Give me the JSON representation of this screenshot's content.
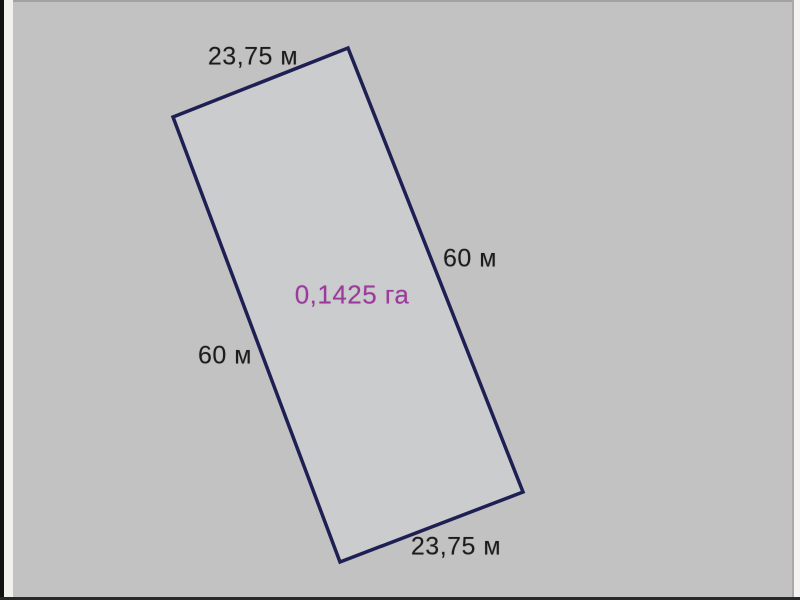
{
  "diagram": {
    "type": "land-parcel-plan",
    "dimensions": {
      "top": "23,75 м",
      "right": "60 м",
      "left": "60 м",
      "bottom": "23,75 м"
    },
    "area_label": "0,1425 га",
    "colors": {
      "background": "#c2c2c2",
      "parcel_fill": "#cbccce",
      "outline": "#1e2054",
      "dimension_text": "#1c1c1c",
      "area_text": "#9c3a9c"
    },
    "outline_width": 3.5,
    "parcel_corners": [
      [
        348,
        48
      ],
      [
        523,
        492
      ],
      [
        340,
        562
      ],
      [
        173,
        117
      ]
    ],
    "label_positions": {
      "top": {
        "x": 253,
        "y": 57
      },
      "right": {
        "x": 470,
        "y": 259
      },
      "area": {
        "x": 352,
        "y": 295
      },
      "left": {
        "x": 225,
        "y": 356
      },
      "bottom": {
        "x": 456,
        "y": 547
      }
    }
  }
}
